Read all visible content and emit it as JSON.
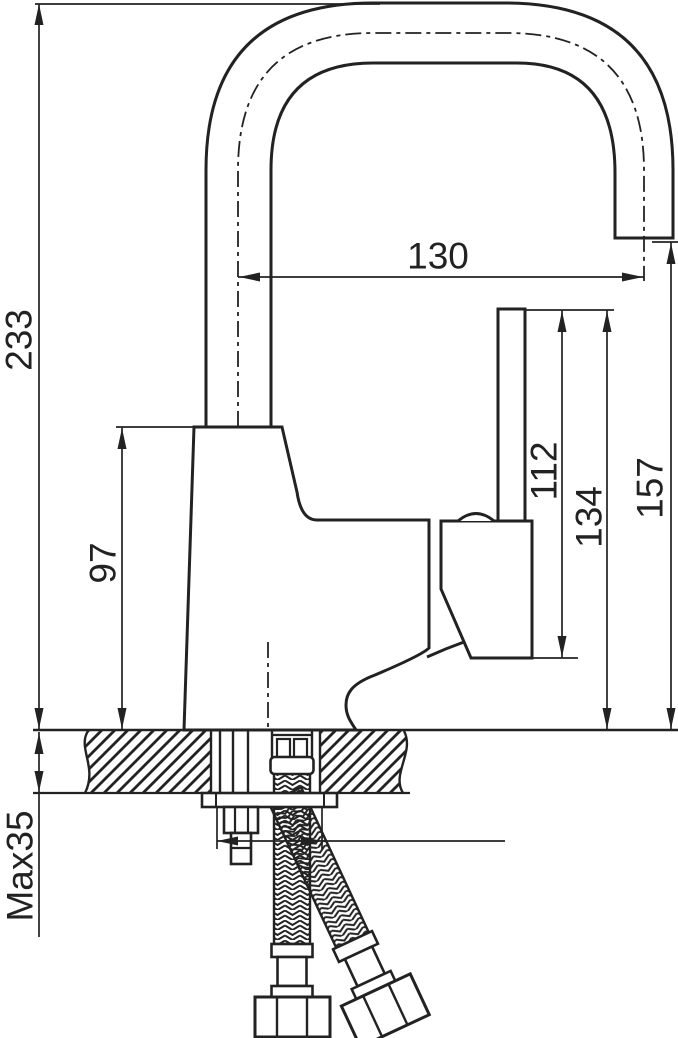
{
  "drawing": {
    "type": "technical-dimension-drawing",
    "subject": "single-lever sink mixer faucet, side elevation with deck mounting cross-section and flexible supply hoses",
    "background_color": "#ffffff",
    "line_color": "#222222",
    "labels": {
      "total_height": "233",
      "body_height": "97",
      "max_deck_thickness": "Max35",
      "spout_reach": "130",
      "lever_top_to_handle_bottom": "112",
      "lever_top_to_deck": "134",
      "spout_outlet_height": "157"
    }
  }
}
